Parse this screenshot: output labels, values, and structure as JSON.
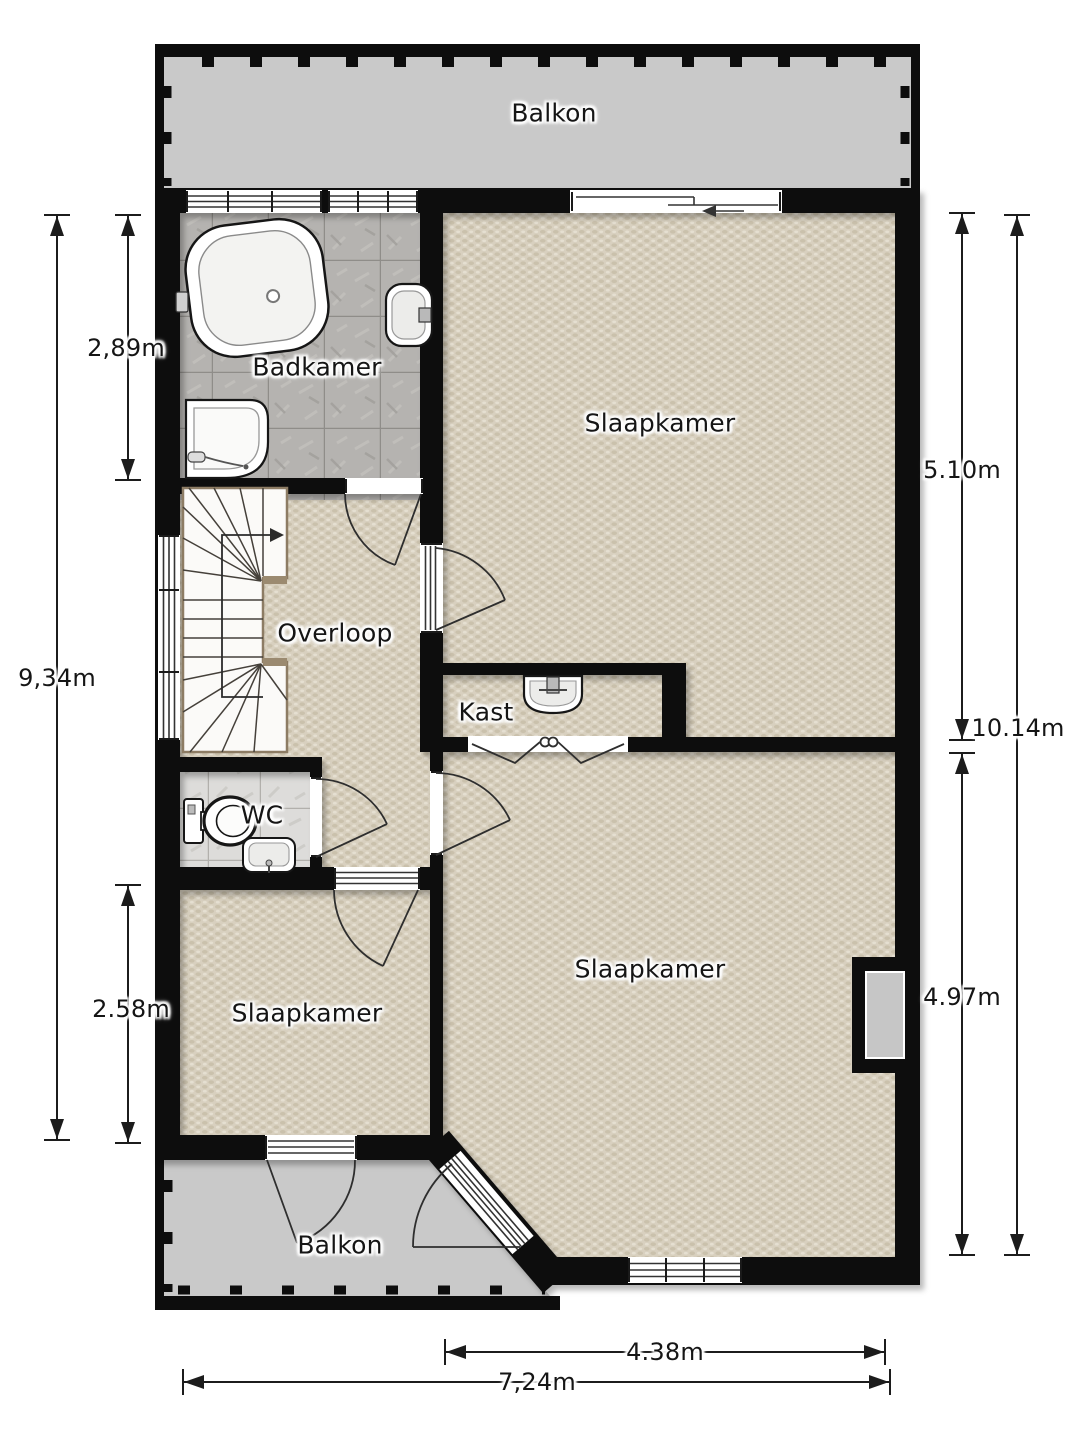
{
  "plan": {
    "type": "floorplan",
    "language": "nl"
  },
  "rooms": {
    "balkon_top": "Balkon",
    "badkamer": "Badkamer",
    "slaapkamer_top": "Slaapkamer",
    "overloop": "Overloop",
    "kast": "Kast",
    "wc": "WC",
    "slaapkamer_left": "Slaapkamer",
    "slaapkamer_right": "Slaapkamer",
    "balkon_bottom": "Balkon"
  },
  "dimensions": {
    "left_top": "2,89m",
    "left_full": "9,34m",
    "left_bottom": "2.58m",
    "right_top": "5.10m",
    "right_full": "10.14m",
    "right_bottom": "4.97m",
    "bottom_inner": "4.38m",
    "bottom_full": "7,24m"
  },
  "colors": {
    "wall": "#0d0d0d",
    "balcony": "#c9c9c9",
    "carpet": "#d8d0bf",
    "bathroom_tile": "#b5b3b0",
    "wc_tile": "#dddcda",
    "line": "#1c1c1c",
    "text": "#151515"
  }
}
